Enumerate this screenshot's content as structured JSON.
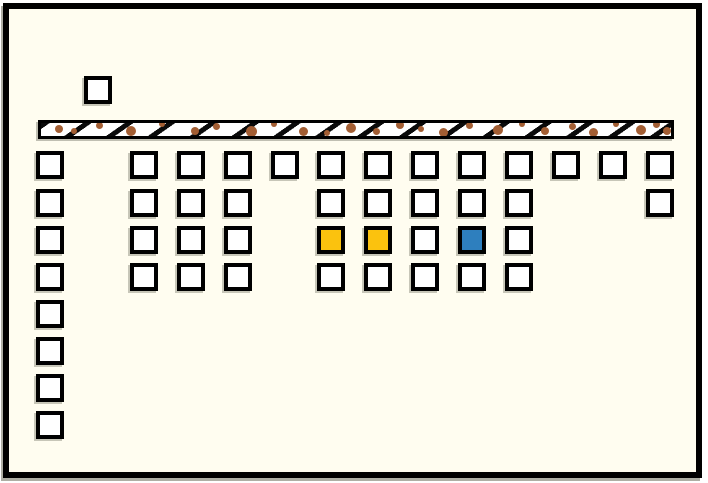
{
  "scene": {
    "title": "tile-grid-diagram",
    "background_color": "#FFFDF0",
    "frame_border_color": "#000000",
    "tile_size": 28
  },
  "colors": {
    "white": "#FFFFFF",
    "yellow": "#FBC20E",
    "blue": "#2E7FBE",
    "tile_border": "#000000",
    "bar_fill": "#FFFFFF",
    "bar_border": "#000000",
    "bar_hatch": "#0A0A0A",
    "dot_brown": "#A35E33"
  },
  "bar": {
    "x": 38,
    "y": 120,
    "width": 636,
    "height": 19,
    "hatch_angle_deg": 145,
    "hatch_stripe_px": 5,
    "hatch_gap_px": 19,
    "dots": [
      [
        14,
        4,
        8
      ],
      [
        30,
        7,
        6
      ],
      [
        55,
        1,
        7
      ],
      [
        85,
        5,
        10
      ],
      [
        118,
        0,
        6
      ],
      [
        150,
        6,
        8
      ],
      [
        172,
        2,
        7
      ],
      [
        205,
        5,
        11
      ],
      [
        230,
        0,
        6
      ],
      [
        258,
        6,
        9
      ],
      [
        283,
        9,
        6
      ],
      [
        305,
        2,
        10
      ],
      [
        332,
        7,
        7
      ],
      [
        355,
        0,
        8
      ],
      [
        377,
        5,
        6
      ],
      [
        398,
        7,
        9
      ],
      [
        425,
        1,
        7
      ],
      [
        452,
        4,
        10
      ],
      [
        478,
        0,
        6
      ],
      [
        500,
        6,
        8
      ],
      [
        528,
        2,
        7
      ],
      [
        548,
        7,
        9
      ],
      [
        572,
        0,
        6
      ],
      [
        595,
        4,
        10
      ],
      [
        612,
        0,
        7
      ],
      [
        622,
        6,
        8
      ]
    ]
  },
  "tiles": [
    {
      "x": 84,
      "y": 76,
      "color": "white"
    },
    {
      "x": 36,
      "y": 151,
      "color": "white"
    },
    {
      "x": 36,
      "y": 189,
      "color": "white"
    },
    {
      "x": 36,
      "y": 226,
      "color": "white"
    },
    {
      "x": 36,
      "y": 263,
      "color": "white"
    },
    {
      "x": 36,
      "y": 300,
      "color": "white"
    },
    {
      "x": 36,
      "y": 337,
      "color": "white"
    },
    {
      "x": 36,
      "y": 374,
      "color": "white"
    },
    {
      "x": 36,
      "y": 411,
      "color": "white"
    },
    {
      "x": 130,
      "y": 151,
      "color": "white"
    },
    {
      "x": 130,
      "y": 189,
      "color": "white"
    },
    {
      "x": 130,
      "y": 226,
      "color": "white"
    },
    {
      "x": 130,
      "y": 263,
      "color": "white"
    },
    {
      "x": 177,
      "y": 151,
      "color": "white"
    },
    {
      "x": 177,
      "y": 189,
      "color": "white"
    },
    {
      "x": 177,
      "y": 226,
      "color": "white"
    },
    {
      "x": 177,
      "y": 263,
      "color": "white"
    },
    {
      "x": 224,
      "y": 151,
      "color": "white"
    },
    {
      "x": 224,
      "y": 189,
      "color": "white"
    },
    {
      "x": 224,
      "y": 226,
      "color": "white"
    },
    {
      "x": 224,
      "y": 263,
      "color": "white"
    },
    {
      "x": 271,
      "y": 151,
      "color": "white"
    },
    {
      "x": 317,
      "y": 151,
      "color": "white"
    },
    {
      "x": 317,
      "y": 189,
      "color": "white"
    },
    {
      "x": 317,
      "y": 226,
      "color": "yellow"
    },
    {
      "x": 317,
      "y": 263,
      "color": "white"
    },
    {
      "x": 364,
      "y": 151,
      "color": "white"
    },
    {
      "x": 364,
      "y": 189,
      "color": "white"
    },
    {
      "x": 364,
      "y": 226,
      "color": "yellow"
    },
    {
      "x": 364,
      "y": 263,
      "color": "white"
    },
    {
      "x": 411,
      "y": 151,
      "color": "white"
    },
    {
      "x": 411,
      "y": 189,
      "color": "white"
    },
    {
      "x": 411,
      "y": 226,
      "color": "white"
    },
    {
      "x": 411,
      "y": 263,
      "color": "white"
    },
    {
      "x": 458,
      "y": 151,
      "color": "white"
    },
    {
      "x": 458,
      "y": 189,
      "color": "white"
    },
    {
      "x": 458,
      "y": 226,
      "color": "blue"
    },
    {
      "x": 458,
      "y": 263,
      "color": "white"
    },
    {
      "x": 505,
      "y": 151,
      "color": "white"
    },
    {
      "x": 505,
      "y": 189,
      "color": "white"
    },
    {
      "x": 505,
      "y": 226,
      "color": "white"
    },
    {
      "x": 505,
      "y": 263,
      "color": "white"
    },
    {
      "x": 552,
      "y": 151,
      "color": "white"
    },
    {
      "x": 599,
      "y": 151,
      "color": "white"
    },
    {
      "x": 646,
      "y": 151,
      "color": "white"
    },
    {
      "x": 646,
      "y": 189,
      "color": "white"
    }
  ]
}
